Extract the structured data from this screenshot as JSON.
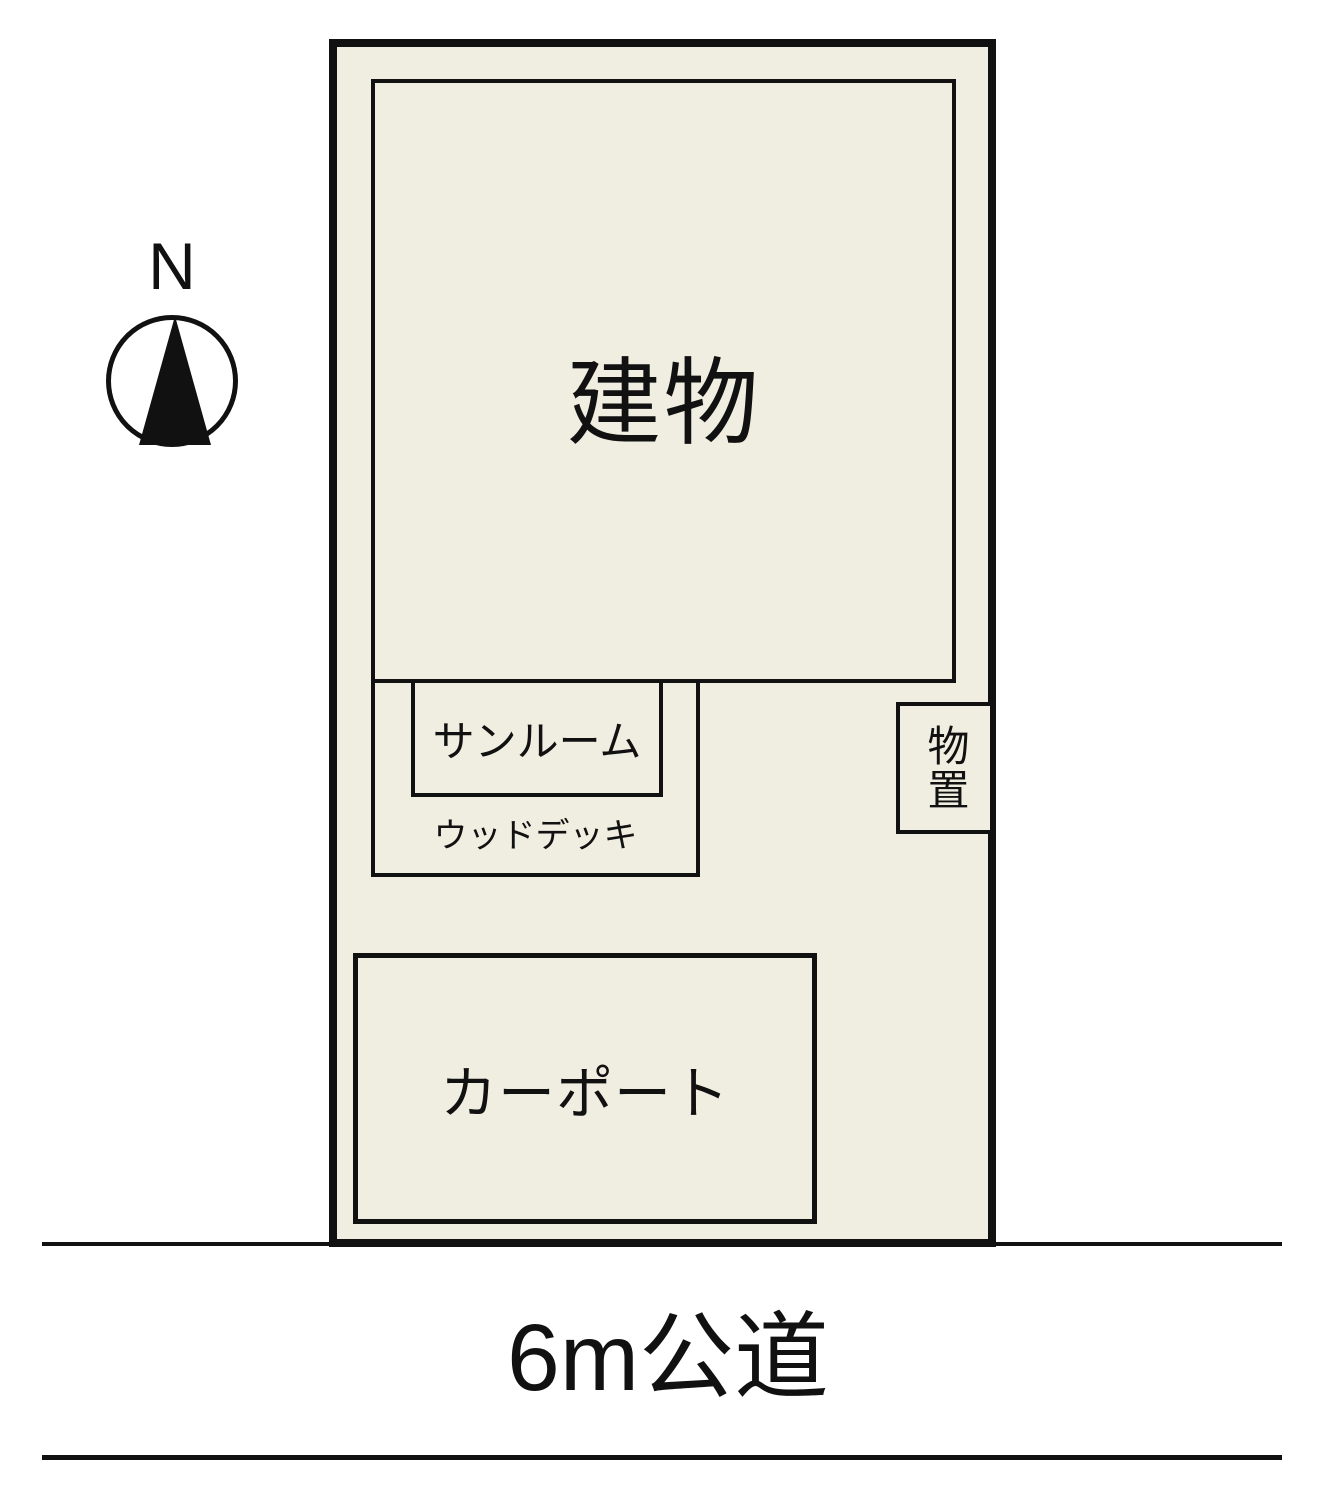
{
  "diagram": {
    "type": "real-estate site plan",
    "compass": {
      "label": "N"
    },
    "site": {
      "areas": {
        "building_label": "建物",
        "sunroom_label": "サンルーム",
        "wood_deck_label": "ウッドデッキ",
        "storage_label": "物置",
        "carport_label": "カーポート"
      }
    },
    "road": {
      "label": "6m公道"
    },
    "colors": {
      "site_fill": "#f0eee0",
      "line": "#111111",
      "background": "#ffffff"
    }
  }
}
